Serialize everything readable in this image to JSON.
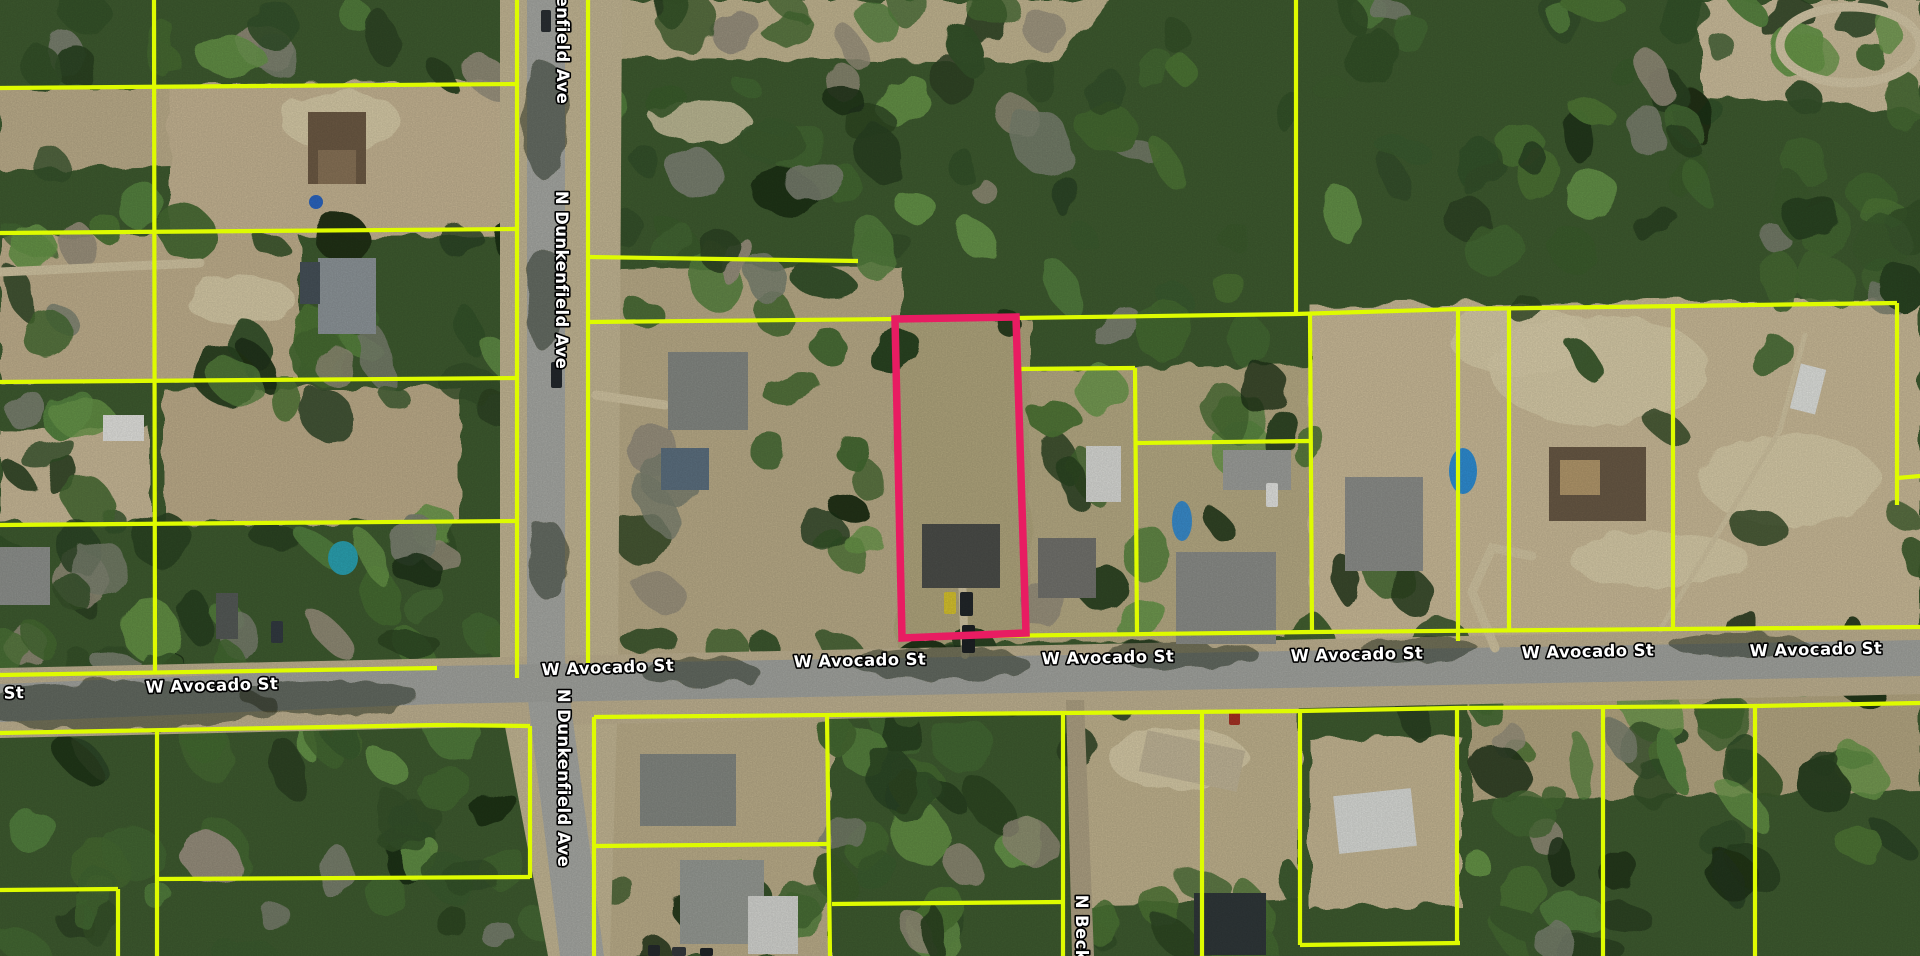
{
  "map": {
    "type": "aerial-parcel-map",
    "width": 1920,
    "height": 956,
    "colors": {
      "forest_base": "#3f5c30",
      "parcel_line": "#defb00",
      "highlight": "#e81c62",
      "pavement": "#a9aba6",
      "shoulder": "#c2b493",
      "label_fill": "#ffffff",
      "label_halo": "#000000"
    },
    "streets": [
      {
        "name": "W Avocado St"
      },
      {
        "name": "N Dunkenfield Ave"
      },
      {
        "name": "N Beckn"
      }
    ],
    "street_labels": [
      {
        "text": "W Avocado St",
        "x": -42,
        "y": 700,
        "rot": -1.6
      },
      {
        "text": "W Avocado St",
        "x": 212,
        "y": 691,
        "rot": -1.6
      },
      {
        "text": "W Avocado St",
        "x": 608,
        "y": 673,
        "rot": -2
      },
      {
        "text": "W Avocado St",
        "x": 860,
        "y": 666,
        "rot": -1.2
      },
      {
        "text": "W Avocado St",
        "x": 1108,
        "y": 663,
        "rot": -1.2
      },
      {
        "text": "W Avocado St",
        "x": 1357,
        "y": 660,
        "rot": -1.2
      },
      {
        "text": "W Avocado St",
        "x": 1588,
        "y": 657,
        "rot": -1.2
      },
      {
        "text": "W Avocado St",
        "x": 1816,
        "y": 655,
        "rot": -1.2
      },
      {
        "text": "N Dunkenfield Ave",
        "x": 557,
        "y": 15,
        "rot": 90
      },
      {
        "text": "N Dunkenfield Ave",
        "x": 556,
        "y": 280,
        "rot": 90
      },
      {
        "text": "N Dunkenfield Ave",
        "x": 558,
        "y": 778,
        "rot": 90
      },
      {
        "text": "N Beckn",
        "x": 1076,
        "y": 934,
        "rot": 90
      }
    ],
    "highlight_parcel": {
      "points": "895,319 1016,317 1026,633 902,638"
    },
    "parcel_lines": [
      "0,88 517,84",
      "0,233 517,229",
      "0,382 517,378",
      "0,525 517,521",
      "0,675 437,668",
      "154,0 155,673",
      "517,0 517,678",
      "588,0 588,663",
      "588,257 858,261",
      "588,322 895,319",
      "1016,318 1296,314 1460,309 1897,303",
      "1296,0 1296,315",
      "1016,369 1135,368",
      "1135,368 1137,633",
      "1137,443 1310,441",
      "1310,314 1312,633",
      "902,637 1312,632 1920,627",
      "1458,309 1458,641",
      "1509,309 1509,630",
      "1673,307 1673,629",
      "1897,303 1897,505",
      "1897,478 1920,476",
      "0,733 437,725 530,726",
      "157,731 157,956",
      "530,726 530,878",
      "157,879 530,877",
      "0,890 118,889",
      "118,889 118,956",
      "594,717 594,956",
      "594,717 1063,713 1300,711 1457,708 1755,706 1920,703",
      "827,716 830,956",
      "596,846 827,844",
      "832,904 1063,902",
      "1063,713 1063,956",
      "1202,711 1202,956",
      "1300,711 1300,945",
      "1300,945 1460,943",
      "1457,708 1457,943",
      "1603,706 1603,956",
      "1755,706 1755,956"
    ],
    "roads": [
      {
        "pts": "500,0 622,0 618,690 610,956 548,956 500,700",
        "fill": "#c6b996"
      },
      {
        "pts": "0,668 1920,626 1920,694 0,738",
        "fill": "#c2b493"
      },
      {
        "pts": "527,0 565,0 565,660 604,956 560,956 527,692",
        "fill": "#a9aba6"
      },
      {
        "pts": "0,684 437,666 1920,640 1920,676 437,704 0,722",
        "fill": "#a4a6a1"
      },
      {
        "pts": "1066,700 1084,700 1094,956 1072,956",
        "fill": "#b0a385"
      }
    ],
    "clearings": [
      {
        "pts": "170,85 515,82 515,235 170,238",
        "fill": "#c8b795"
      },
      {
        "pts": "0,90 170,88 170,165 0,170",
        "fill": "#bfb08d"
      },
      {
        "pts": "0,236 300,233 300,380 0,383",
        "fill": "#c3b28f"
      },
      {
        "pts": "0,430 150,428 150,521 0,524",
        "fill": "#cbbb99"
      },
      {
        "pts": "165,390 460,387 460,520 165,524",
        "fill": "#c0af8c"
      },
      {
        "pts": "560,0 1110,0 1060,62 600,58",
        "fill": "#c5b893"
      },
      {
        "pts": "1700,0 1920,0 1920,112 1700,95",
        "fill": "#cfc09e"
      },
      {
        "pts": "590,270 900,265 900,660 590,665",
        "fill": "#bcae8a"
      },
      {
        "pts": "895,320 1030,318 1030,645 898,648",
        "fill": "#b3a87f"
      },
      {
        "pts": "1030,370 1310,365 1315,640 1030,645",
        "fill": "#b9ad86"
      },
      {
        "pts": "1310,305 1920,298 1920,640 1310,645",
        "fill": "#cdbd9a"
      },
      {
        "pts": "600,715 830,712 830,956 600,956",
        "fill": "#beb08c"
      },
      {
        "pts": "1080,700 1300,705 1300,900 1080,905",
        "fill": "#c3b590"
      },
      {
        "pts": "1310,740 1460,735 1460,905 1310,910",
        "fill": "#c8b995"
      },
      {
        "pts": "1470,690 1920,680 1920,790 1470,800",
        "fill": "#b7a984"
      }
    ],
    "pale_patches": [
      [
        1600,
        370,
        110,
        55
      ],
      [
        1790,
        480,
        90,
        45
      ],
      [
        1520,
        340,
        70,
        35
      ],
      [
        1660,
        560,
        90,
        28
      ],
      [
        340,
        120,
        60,
        30
      ],
      [
        240,
        300,
        55,
        25
      ],
      [
        1180,
        760,
        70,
        30
      ],
      [
        700,
        120,
        50,
        22
      ]
    ],
    "forest_regions": [
      [
        0,
        0,
        520,
        90,
        14,
        11
      ],
      [
        0,
        90,
        170,
        580,
        22,
        22
      ],
      [
        170,
        230,
        350,
        160,
        16,
        33
      ],
      [
        0,
        525,
        520,
        150,
        30,
        44
      ],
      [
        170,
        380,
        350,
        40,
        6,
        55
      ],
      [
        565,
        0,
        730,
        330,
        70,
        66
      ],
      [
        1296,
        0,
        624,
        310,
        60,
        77
      ],
      [
        590,
        320,
        310,
        340,
        22,
        88
      ],
      [
        1030,
        330,
        280,
        320,
        18,
        99
      ],
      [
        1310,
        300,
        610,
        350,
        10,
        110
      ],
      [
        0,
        720,
        600,
        236,
        40,
        121
      ],
      [
        830,
        640,
        250,
        316,
        28,
        132
      ],
      [
        600,
        880,
        230,
        76,
        8,
        143
      ],
      [
        1080,
        640,
        840,
        120,
        26,
        154
      ],
      [
        1460,
        760,
        460,
        196,
        30,
        165
      ],
      [
        1080,
        880,
        230,
        80,
        10,
        176
      ]
    ],
    "driveways": [
      {
        "pts": "0,272 200,263",
        "w": 9
      },
      {
        "pts": "965,655 962,575",
        "w": 8
      },
      {
        "pts": "596,395 665,405",
        "w": 9
      },
      {
        "pts": "1495,648 1472,592 1492,548 1532,556",
        "w": 9
      },
      {
        "pts": "1660,630 1780,430 1805,335",
        "w": 5
      }
    ],
    "track_ring": [
      1850,
      45,
      70,
      38
    ],
    "buildings": [
      [
        308,
        112,
        58,
        72,
        0,
        "#6e5b45"
      ],
      [
        318,
        150,
        38,
        34,
        0,
        "#8a7458"
      ],
      [
        318,
        258,
        58,
        76,
        0,
        "#8f979b"
      ],
      [
        300,
        262,
        20,
        42,
        0,
        "#47525a"
      ],
      [
        103,
        415,
        41,
        26,
        0,
        "#e6e6e2"
      ],
      [
        0,
        547,
        50,
        58,
        0,
        "#90938f"
      ],
      [
        216,
        593,
        22,
        46,
        0,
        "#565b58"
      ],
      [
        668,
        352,
        80,
        78,
        0,
        "#868a85"
      ],
      [
        661,
        448,
        48,
        42,
        0,
        "#5d7181"
      ],
      [
        922,
        524,
        78,
        64,
        0,
        "#4c4e4a"
      ],
      [
        1086,
        446,
        35,
        56,
        0,
        "#dcddd9"
      ],
      [
        1038,
        538,
        58,
        60,
        0,
        "#74746f"
      ],
      [
        1176,
        552,
        100,
        92,
        0,
        "#8d8f8b"
      ],
      [
        1223,
        450,
        68,
        40,
        0,
        "#9fa19d"
      ],
      [
        1345,
        477,
        78,
        94,
        0,
        "#8e908c"
      ],
      [
        1549,
        447,
        97,
        74,
        0,
        "#6a5a46"
      ],
      [
        1560,
        460,
        40,
        35,
        0,
        "#b59a6d"
      ],
      [
        1795,
        366,
        26,
        46,
        14,
        "#e3e5e1"
      ],
      [
        640,
        754,
        96,
        72,
        0,
        "#858983"
      ],
      [
        680,
        860,
        84,
        84,
        0,
        "#989c96"
      ],
      [
        748,
        896,
        50,
        58,
        0,
        "#d7d8d4"
      ],
      [
        1142,
        740,
        100,
        42,
        12,
        "#c4b89a"
      ],
      [
        1336,
        792,
        78,
        58,
        -6,
        "#dddfdb"
      ],
      [
        1194,
        893,
        72,
        62,
        0,
        "#30383a"
      ]
    ],
    "pools": [
      [
        316,
        202,
        7,
        7,
        "#2b66c2"
      ],
      [
        343,
        558,
        15,
        17,
        "#2ba4b4"
      ],
      [
        1182,
        521,
        10,
        20,
        "#3a8ecf"
      ],
      [
        1463,
        471,
        14,
        23,
        "#2f8fd6"
      ]
    ],
    "cars": [
      [
        944,
        592,
        12,
        22,
        0,
        "#d9c52f"
      ],
      [
        960,
        592,
        13,
        24,
        0,
        "#22272a"
      ],
      [
        962,
        625,
        13,
        28,
        0,
        "#1d2124"
      ],
      [
        551,
        362,
        11,
        26,
        0,
        "#23282c"
      ],
      [
        541,
        10,
        10,
        22,
        0,
        "#2a2f33"
      ],
      [
        1229,
        712,
        11,
        13,
        0,
        "#a83324"
      ],
      [
        648,
        945,
        12,
        11,
        0,
        "#252a2d"
      ],
      [
        672,
        947,
        14,
        9,
        0,
        "#34393c"
      ],
      [
        700,
        948,
        13,
        8,
        0,
        "#202528"
      ],
      [
        1266,
        483,
        12,
        24,
        0,
        "#e6e7e4"
      ],
      [
        271,
        621,
        12,
        22,
        0,
        "#333b42"
      ]
    ],
    "road_shadows": [
      [
        120,
        706,
        160,
        24
      ],
      [
        330,
        697,
        90,
        18
      ],
      [
        700,
        672,
        60,
        14
      ],
      [
        940,
        664,
        90,
        16
      ],
      [
        1180,
        655,
        80,
        14
      ],
      [
        1420,
        650,
        60,
        12
      ],
      [
        545,
        120,
        22,
        60
      ],
      [
        545,
        300,
        20,
        52
      ],
      [
        548,
        560,
        20,
        40
      ],
      [
        1740,
        645,
        70,
        12
      ]
    ]
  }
}
